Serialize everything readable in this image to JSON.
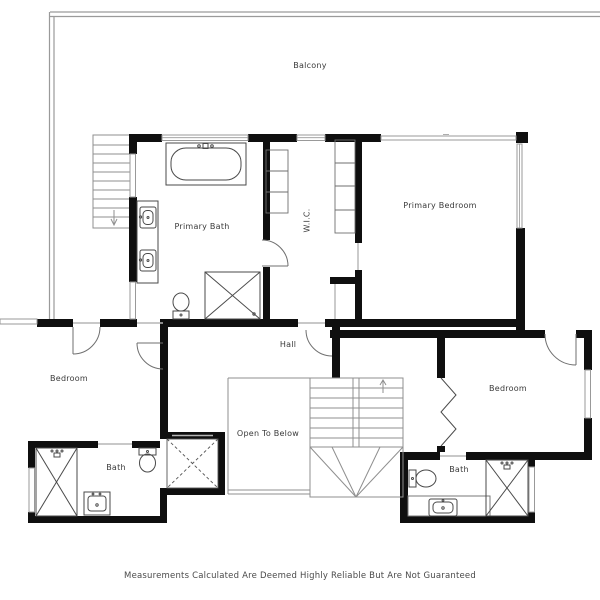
{
  "document": {
    "type": "floor-plan",
    "disclaimer": "Measurements Calculated Are Deemed Highly Reliable But Are Not Guaranteed"
  },
  "rooms": {
    "balcony": "Balcony",
    "primary_bath": "Primary Bath",
    "wic": "W.I.C.",
    "primary_bedroom": "Primary Bedroom",
    "hall": "Hall",
    "open_to_below": "Open To Below",
    "bedroom_left": "Bedroom",
    "bedroom_right": "Bedroom",
    "bath_left": "Bath",
    "bath_right": "Bath"
  },
  "features": {
    "exterior_stairs": "balcony-stairs",
    "central_stairs": "stairs-to-below",
    "shaft": "elevator-shaft",
    "fixtures": [
      "bathtub",
      "double-vanity",
      "toilet",
      "shower",
      "sink",
      "bifold-closet-door"
    ]
  },
  "colors": {
    "wall": "#0f0f0f",
    "thin_line": "#8f8f8f",
    "railing": "#9a9a9a",
    "fixture": "#4a4a4a",
    "text": "#3a3a3a",
    "background": "#ffffff"
  }
}
